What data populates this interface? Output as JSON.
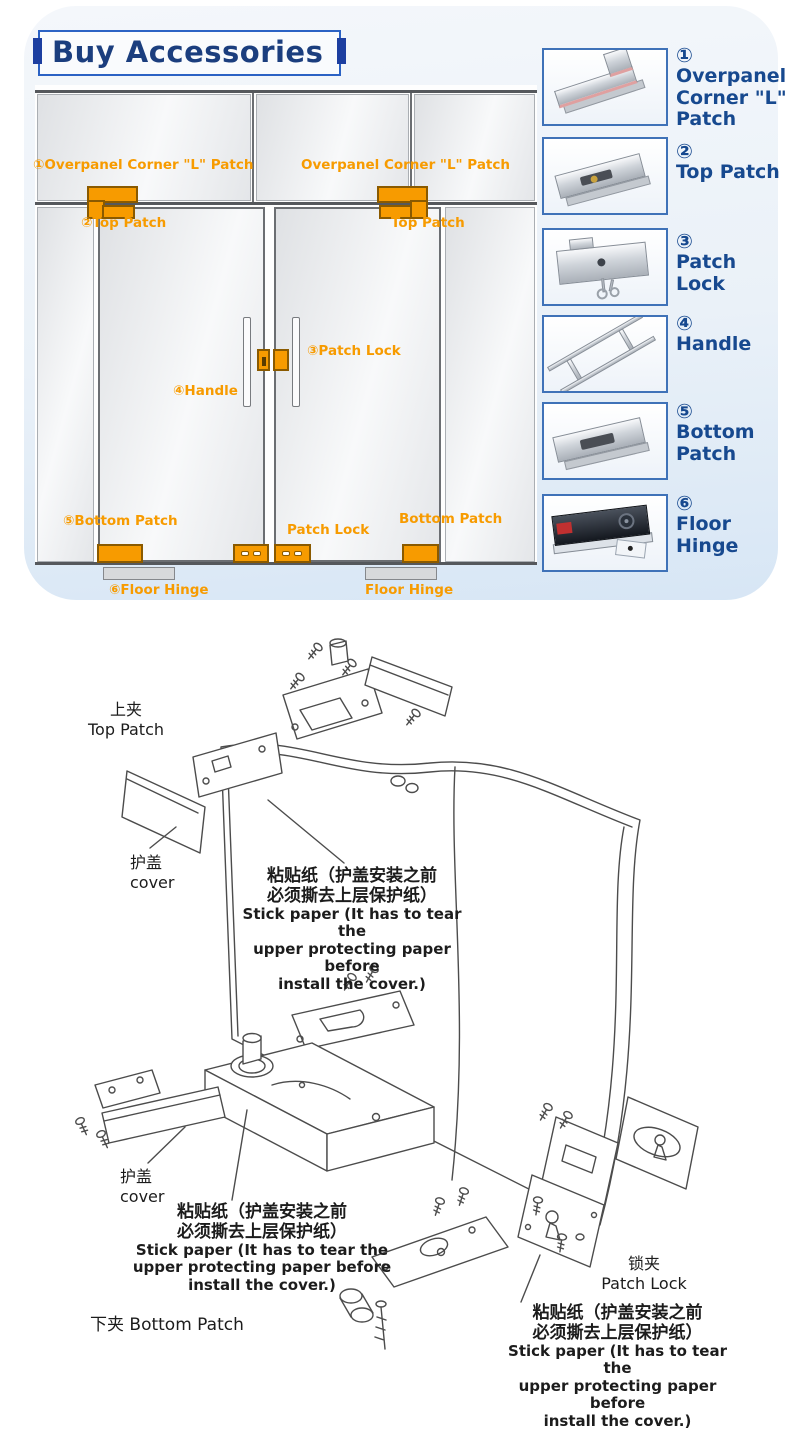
{
  "header": {
    "title": "Buy Accessories"
  },
  "colors": {
    "accent_orange": "#F79B00",
    "label_navy": "#17498F",
    "thumb_border_blue": "#3F72B8",
    "title_frame_blue": "#2B62C4",
    "panel_bg_blue": "#D7E6F5"
  },
  "door_diagram": {
    "labels": [
      {
        "id": "overpanel-left",
        "text": "①Overpanel Corner \"L\" Patch"
      },
      {
        "id": "overpanel-right",
        "text": "Overpanel Corner \"L\" Patch"
      },
      {
        "id": "top-patch-left",
        "text": "②Top Patch"
      },
      {
        "id": "top-patch-right",
        "text": "Top Patch"
      },
      {
        "id": "patch-lock-mid",
        "text": "③Patch Lock"
      },
      {
        "id": "handle",
        "text": "④Handle"
      },
      {
        "id": "bottom-patch-left",
        "text": "⑤Bottom Patch"
      },
      {
        "id": "patch-lock-floor",
        "text": "Patch Lock"
      },
      {
        "id": "bottom-patch-right",
        "text": "Bottom Patch"
      },
      {
        "id": "floor-hinge-left",
        "text": "⑥Floor Hinge"
      },
      {
        "id": "floor-hinge-right",
        "text": "Floor Hinge"
      }
    ]
  },
  "products": [
    {
      "num": "①",
      "name": "Overpanel Corner \"L\" Patch"
    },
    {
      "num": "②",
      "name": "Top Patch"
    },
    {
      "num": "③",
      "name": "Patch Lock"
    },
    {
      "num": "④",
      "name": "Handle"
    },
    {
      "num": "⑤",
      "name": "Bottom Patch"
    },
    {
      "num": "⑥",
      "name": "Floor Hinge"
    }
  ],
  "exploded": {
    "top_patch_cn": "上夹",
    "top_patch_en": "Top Patch",
    "cover_cn": "护盖",
    "cover_en": "cover",
    "stick_cn_1": "粘贴纸（护盖安装之前",
    "stick_cn_2": "必须撕去上层保护纸）",
    "stick_en_1": "Stick paper (It has to tear the",
    "stick_en_2": "upper protecting paper before",
    "stick_en_3": "install the cover.)",
    "bottom_patch_cn": "下夹",
    "bottom_patch_en": "Bottom Patch",
    "patch_lock_cn": "锁夹",
    "patch_lock_en": "Patch Lock"
  }
}
